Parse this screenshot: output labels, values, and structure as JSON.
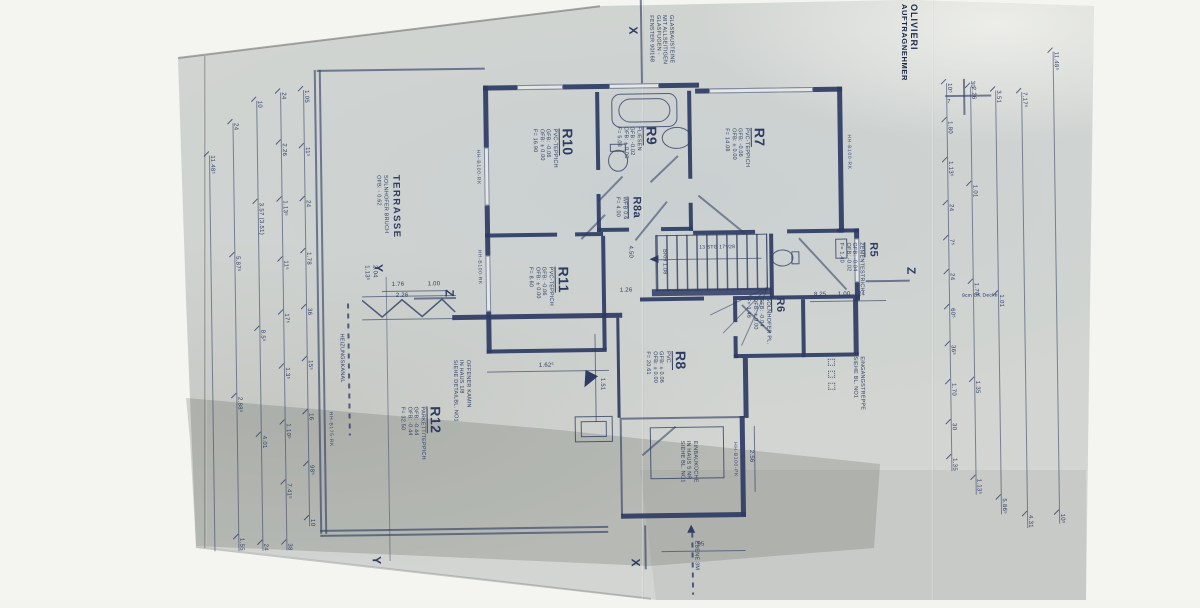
{
  "title_block": {
    "line1": "AUFTRAGNEHMER",
    "line2": "OLIVIERI"
  },
  "rooms": {
    "r10": {
      "id": "R10",
      "lines": [
        "PVC-TEPPICH",
        "GFB: -0.06",
        "OFB: ± 0.00",
        "F= 16.90"
      ]
    },
    "r9": {
      "id": "R9",
      "lines": [
        "FLIESEN",
        "GFB: -0.02",
        "OFB: ± 0.00",
        "F= 5.08"
      ]
    },
    "r7": {
      "id": "R7",
      "lines": [
        "PVC-TEPPICH",
        "GFB: -0.06",
        "OFB: ± 0.00",
        "F= 14.08"
      ]
    },
    "r8a": {
      "id": "R8a",
      "lines": [
        "WFB 0.6",
        "F= 4.00"
      ]
    },
    "r5": {
      "id": "R5",
      "lines": [
        "ZEMENTESTRICH",
        "GFB: -0.04",
        "OFB: -0.02",
        "F= 1.40"
      ]
    },
    "r6": {
      "id": "R6",
      "lines": [
        "SOLNHOFER PL.",
        "GFB: -0.04",
        "OFB: ± 0.00",
        "F= 1.46"
      ]
    },
    "r11": {
      "id": "R11",
      "lines": [
        "PVC-TEPPICH",
        "GFB: -0.06",
        "OFB: ± 0.00",
        "F= 8.60"
      ]
    },
    "r8": {
      "id": "R8",
      "lines": [
        "PVC",
        "GFB: ± 0.06",
        "OFB: ± 0.00",
        "F= 20.61"
      ]
    },
    "r12": {
      "id": "R12",
      "lines": [
        "PARKETT/TEPPICH",
        "GFB: -0.44",
        "OFB: -0.44",
        "F= 32.50"
      ]
    },
    "terrasse": {
      "id": "TERRASSE",
      "lines": [
        "SOLNHOFER BRUCH",
        "OFB: - 0.62"
      ]
    }
  },
  "notes": {
    "glas": [
      "GLASBAUSTEINE",
      "MIT ALLSEITIGEN",
      "GLASFUGEN -",
      "FENSTER 90/168"
    ],
    "heizungskanal": "HEIZUNGSKANAL",
    "kamin": [
      "OFFENER KAMIN",
      "IN HAUS 1/8",
      "SIEHE DETAILBL. NO1"
    ],
    "kueche": [
      "EINBAUKÜCHE",
      "IN HAUS 5 NR",
      "SIEHE BL. NO1"
    ],
    "treppe": [
      "EINGANGSTREPPE",
      "SIEHE BL. NO1"
    ],
    "ebene": "EBENE 3M",
    "brh": "BRH 1.08",
    "stg": "13 STG 17⁵/28",
    "uk_decke": "9cm UK Decke"
  },
  "wall_labels": {
    "w1": "HH-B100-RK",
    "w2": "HH-B100-RK",
    "w3": "HH-B175-RK",
    "w4": "HH-B100-PK",
    "w5": "HH-B100-RK"
  },
  "markers": {
    "x": "X",
    "y": "Y",
    "z": "Z"
  },
  "dims": {
    "left": {
      "l1": [
        "11.48⁵"
      ],
      "l2": [
        "24",
        "5.87⁵",
        "2.88⁵",
        "1.55"
      ],
      "l3": [
        "10",
        "3.57 (3.51)",
        "8.5⁵",
        "4.01",
        "24"
      ],
      "l4": [
        "24",
        "2.26",
        "1.13⁵",
        "11⁵",
        "17⁵",
        "1.3⁵",
        "1.10⁵",
        "7.41⁵",
        "38"
      ],
      "l5": [
        "1.05",
        "11⁵",
        "24",
        "1.78",
        "36",
        "15⁵",
        "16",
        "98⁵",
        "10"
      ]
    },
    "right": {
      "r1": [
        "10⁵",
        "1.80",
        "1.13⁵",
        "24",
        "7⁵",
        "24",
        "60⁵",
        "36⁵",
        "1.70",
        "30",
        "1.35"
      ],
      "r2": [
        "2.26",
        "1.01",
        "1.70",
        "1.35",
        "1.13⁵"
      ],
      "r3": [
        "3.51",
        "1.01",
        "5.86⁵"
      ],
      "r4": [
        "7.17⁵",
        "4.31"
      ],
      "r5": [
        "11.48⁵",
        "10⁵"
      ]
    },
    "top_corner": [
      "30",
      "7"
    ],
    "inner": {
      "d176": "1.76",
      "d226": "2.26",
      "d100": "1.00",
      "d1625": "1.62⁵",
      "d95": "95",
      "d825": "8.25",
      "d100b": "1.00",
      "d24": "24",
      "d126": "1.26",
      "d256": "2.56",
      "d1135": "1.13⁵",
      "d204": "2.04",
      "d450": "4.50",
      "d151": "1.51"
    }
  }
}
